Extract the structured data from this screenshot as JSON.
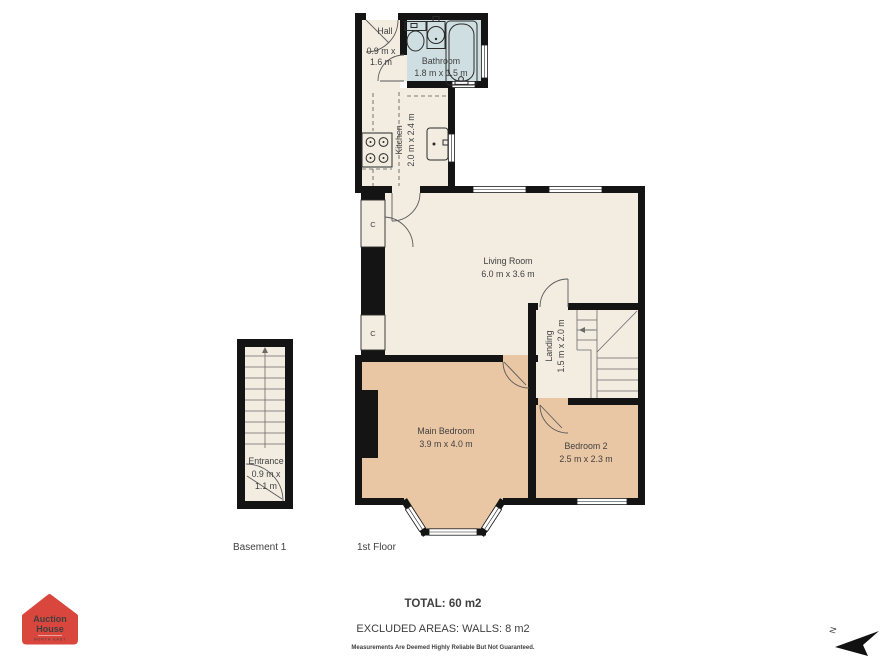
{
  "plan": {
    "floors": {
      "basement": {
        "label": "Basement 1"
      },
      "first": {
        "label": "1st Floor"
      }
    },
    "rooms": {
      "hall": {
        "name": "Hall",
        "dim_line1": "0.9 m x",
        "dim_line2": "1.6 m"
      },
      "bathroom": {
        "name": "Bathroom",
        "dims": "1.8 m x 1.5 m"
      },
      "kitchen": {
        "name": "Kitchen",
        "dims": "2.0 m x 2.4 m"
      },
      "living_room": {
        "name": "Living Room",
        "dims": "6.0 m x 3.6 m"
      },
      "landing": {
        "name": "Landing",
        "dims": "1.5 m x 2.0 m"
      },
      "main_bedroom": {
        "name": "Main Bedroom",
        "dims": "3.9 m x 4.0 m"
      },
      "bedroom_2": {
        "name": "Bedroom 2",
        "dims": "2.5 m x 2.3 m"
      },
      "entrance": {
        "name": "Entrance",
        "dim_line1": "0.9 m x",
        "dim_line2": "1.1 m"
      },
      "cupboard": {
        "label": "C"
      }
    },
    "summary": {
      "total": "TOTAL: 60 m2",
      "excluded": "EXCLUDED AREAS: WALLS: 8 m2",
      "disclaimer": "Measurements Are Deemed Highly Reliable But Not Guaranteed."
    },
    "compass": {
      "label": "N"
    },
    "logo": {
      "line1": "Auction",
      "line2": "House",
      "region": "NORTH EAST"
    },
    "colors": {
      "room_cream": "#f2ece1",
      "room_peach": "#eac7a4",
      "room_bath": "#cfdfe1",
      "wall": "#141414",
      "logo_red": "#d8463d"
    }
  }
}
